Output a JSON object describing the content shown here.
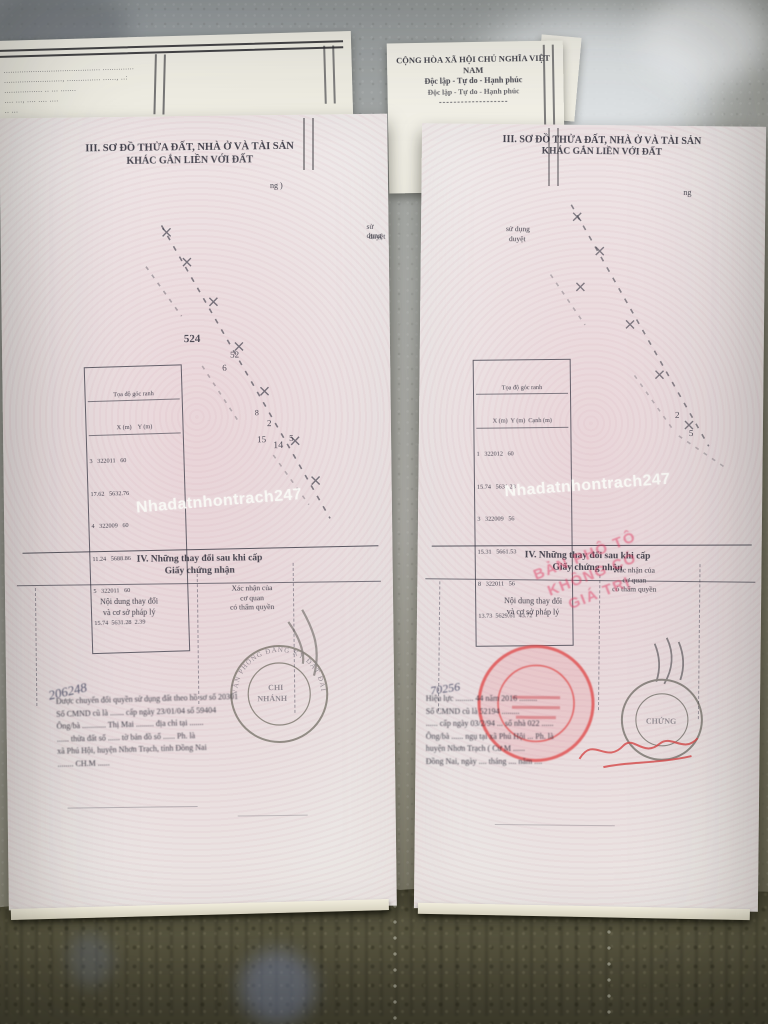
{
  "palette": {
    "paper_pink": "#ebe5e4",
    "paper_white": "#f4f2ea",
    "ink": "#2e2e38",
    "stamp_red": "#d84848",
    "overlay_pink": "#de3e62",
    "watermark_white": "#f8f8f5",
    "marble_gray": "#a6a8a4",
    "floor_olive": "#5c5943"
  },
  "watermark": {
    "text": "Nhadatnhontrach247"
  },
  "sheets": {
    "left": {
      "rows": [
        "...........................................  ..............",
        ".........................., ...............  ......, ..:",
        ".................  ..  ...  .......",
        "....  ...,  ....  ....  ....",
        "..  ..."
      ]
    },
    "right": {
      "title": "CỘNG HÒA XÃ HỘI CHỦ NGHĨA VIỆT NAM",
      "motto": "Độc lập - Tự do - Hạnh phúc",
      "motto2": "Độc lập - Tự do - Hạnh phúc",
      "rule": "-------------------"
    }
  },
  "left_doc": {
    "title1": "III. SƠ ĐỒ THỬA ĐẤT, NHÀ Ở VÀ TÀI SẢN",
    "title2": "KHÁC GẮN LIỀN VỚI ĐẤT",
    "frag_ng": "ng )",
    "frag_sd": "sử dụng",
    "frag_duyet": "duyệt",
    "dia": {
      "l1": "524",
      "l2": "52",
      "l3": "6",
      "l4": "2",
      "l5": "15",
      "l6": "14",
      "l7": "5",
      "l8": "8"
    },
    "table": {
      "h1": "Tọa độ góc ranh",
      "h2": "X (m)    Y (m)",
      "rows": [
        "3   322011   60",
        "17.62   5632.76",
        "4   322009   60",
        "11.24   5688.86",
        "5   322011   60",
        "15.74  5631.28  2.39"
      ]
    },
    "s4a": "IV. Những thay đổi sau khi cấp",
    "s4b": "Giấy chứng nhận",
    "colL1": "Nội dung thay đổi",
    "colL2": "và cơ sở pháp lý",
    "colR1": "Xác nhận của",
    "colR2": "cơ quan",
    "colR3": "có thẩm quyền",
    "stamp": {
      "arc": "VĂN PHÒNG ĐĂNG KÝ ĐẤT ĐAI",
      "c1": "CHI",
      "c2": "NHÁNH"
    },
    "hand": "206248",
    "notes": [
      "Được chuyển đổi quyền sử dụng đất theo hồ sơ số 20301",
      "Số CMND cũ là ....... cấp ngày 23/01/04  số 59404",
      "Ông/bà ............ Thị Mai ......... địa chỉ tại .......",
      "...... thửa đất số ...... tờ bản đồ số ...... Ph. là",
      "xã Phú Hội, huyện Nhơn Trạch, tỉnh Đồng Nai",
      "........  CH.M  ......"
    ]
  },
  "right_doc": {
    "title1": "III. SƠ ĐỒ THỬA ĐẤT, NHÀ Ở VÀ TÀI SẢN",
    "title2": "KHÁC GẮN LIỀN VỚI ĐẤT",
    "frag_ng": "ng",
    "frag_sd": "sử dụng",
    "frag_duyet": "duyệt",
    "dia": {
      "l1": "5",
      "l2": "2"
    },
    "table": {
      "h1": "Tọa độ góc ranh",
      "h2": "X (m)  Y (m)  Cạnh (m)",
      "rows": [
        "1   322012   60",
        "15.74   5631.28",
        "3   322009   56",
        "15.31   5661.53",
        "8   322011   56",
        "13.73  5629.61  43.72"
      ]
    },
    "s4a": "IV. Những thay đổi sau khi cấp",
    "s4b": "Giấy chứng nhận",
    "colL1": "Nội dung thay đổi",
    "colL2": "và cơ sở pháp lý",
    "colR1": "Xác nhận của",
    "colR2": "cơ quan",
    "colR3": "có thẩm quyền",
    "red_overlay": {
      "l1": "BẢN PHÔ TÔ",
      "l2": "KHÔNG CÓ",
      "l3": "GIÁ TRỊ"
    },
    "stamp2_frag": "CHỨNG",
    "hand": "70256",
    "notes": [
      "Hiệu lực ......... 44 năm 2016 .........",
      "Số CMND cũ là 52194 .........",
      "...... cấp ngày 03/2/94 ... số nhà 022 ......",
      "Ông/bà ...... ngụ tại xã Phú Hội ... Ph. là",
      "huyện Nhơn Trạch  ( Cư M ......",
      "Đồng Nai, ngày .... tháng .... năm ...."
    ]
  }
}
